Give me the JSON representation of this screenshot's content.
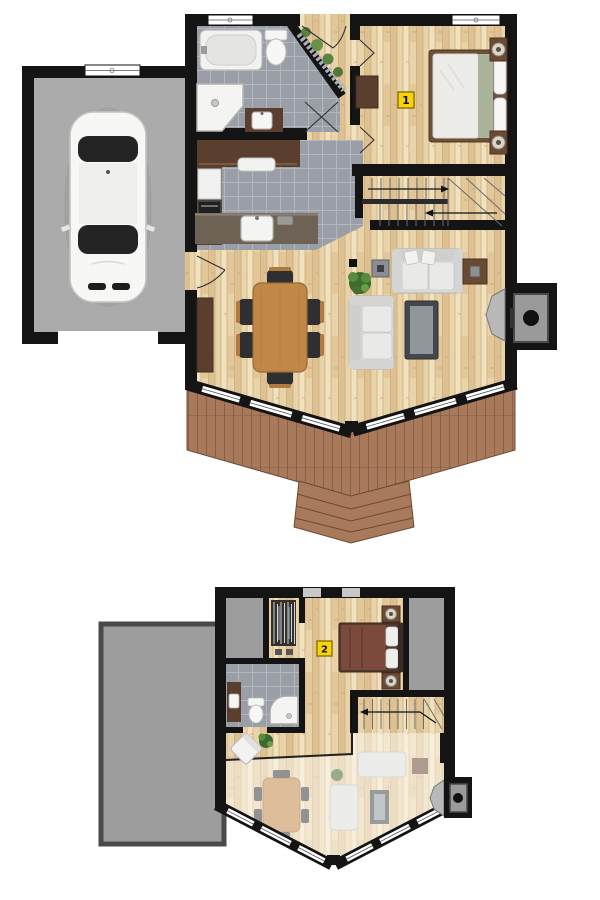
{
  "markers": {
    "main_floor": "1",
    "upper_floor": "2"
  },
  "colors": {
    "wall": "#141414",
    "wood_floor": "#e9d3a9",
    "wood_floor_dark": "#ddc192",
    "tile_floor": "#999ea7",
    "tile_grout": "#b3b8bf",
    "garage_floor": "#ababab",
    "roof_concrete": "#9d9d9d",
    "deck_wood": "#a8795a",
    "deck_line": "#8a5f44",
    "counter_wood": "#5a3f2e",
    "furniture_wood": "#6b4a33",
    "table_wood": "#c18747",
    "sofa_fabric": "#e2e2e0",
    "bed1_accent": "#a9b49b",
    "bed2_duvet": "#7b4a3c",
    "plant_green": "#4e7a38",
    "marker_bg": "#f7d308",
    "marker_border": "#8a7400",
    "marker_text": "#111111"
  },
  "floors": {
    "main": {
      "marker_label": "1",
      "rooms": [
        "garage",
        "bathroom",
        "entry",
        "bedroom",
        "kitchen",
        "dining-area",
        "living-room",
        "staircase",
        "deck"
      ],
      "items": [
        "car",
        "bathtub",
        "toilet",
        "corner-shower",
        "vanity-sink",
        "kitchen-counters",
        "fridge",
        "stove",
        "peninsula-sink",
        "dining-table",
        "six-chairs",
        "buffet",
        "sofa",
        "loveseat",
        "coffee-table",
        "tv-stand",
        "side-table",
        "plant",
        "wood-stove-fireplace",
        "double-bed",
        "two-nightstands",
        "dresser",
        "u-stairs-up",
        "deck-steps"
      ]
    },
    "upper": {
      "marker_label": "2",
      "rooms": [
        "attic-storage-left",
        "walk-in-closet",
        "bathroom",
        "bedroom",
        "staircase",
        "landing-open-to-below",
        "garage-roof"
      ],
      "items": [
        "hanging-clothes",
        "vanity-sink",
        "toilet",
        "corner-shower",
        "double-bed",
        "two-nightstands",
        "armchair",
        "plant",
        "stairs-down",
        "chimney-wood-stove",
        "ghost-living-room-furniture"
      ]
    }
  }
}
